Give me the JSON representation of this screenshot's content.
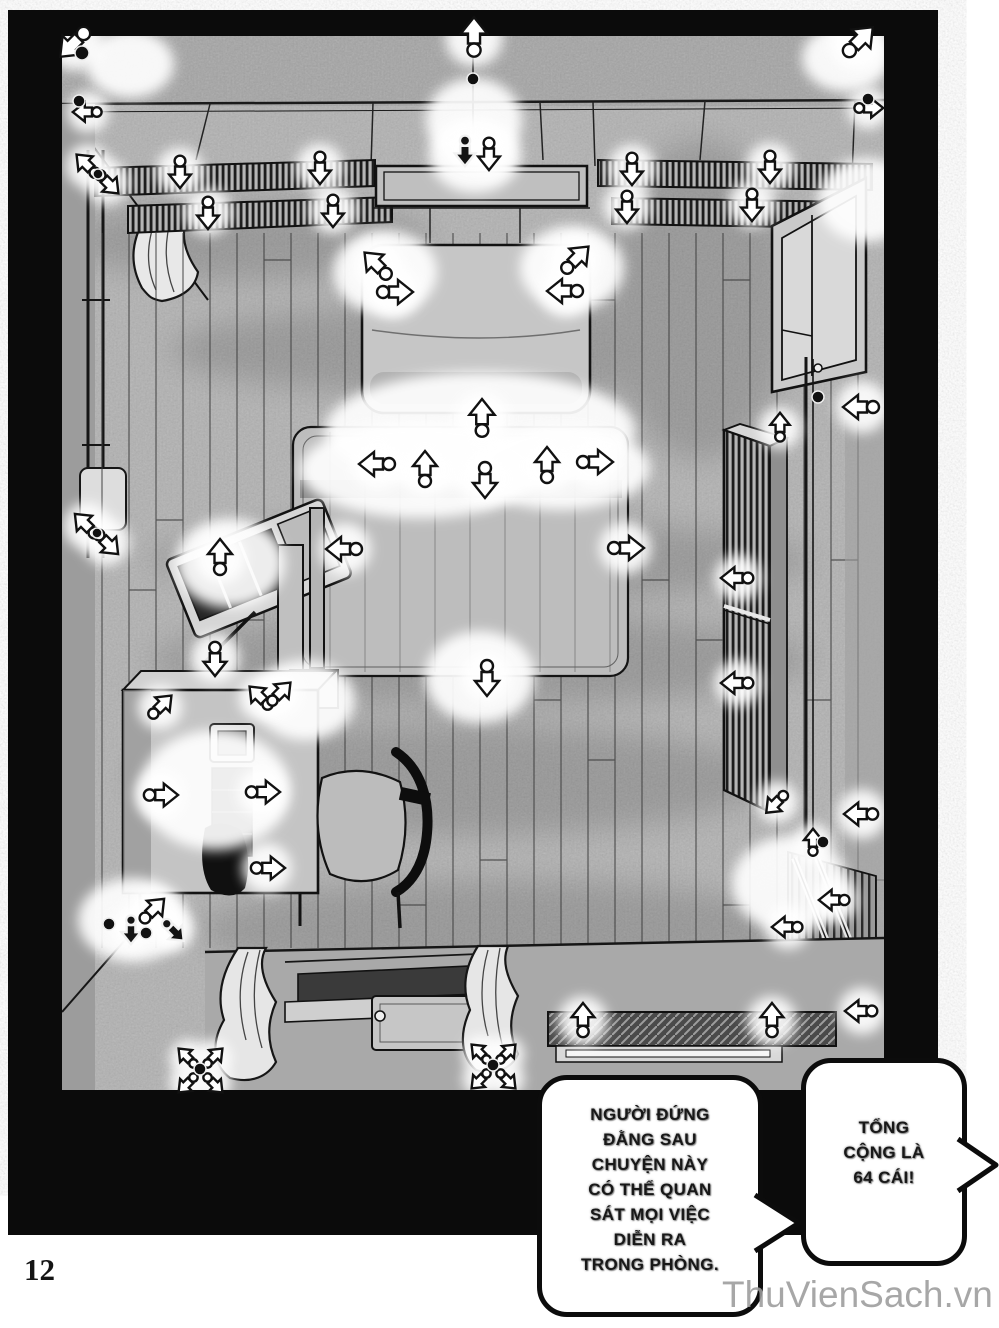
{
  "page": {
    "number": "12",
    "watermark": "ThuVienSach.vn"
  },
  "bubbles": {
    "left": {
      "lines": [
        "NGƯỜI ĐỨNG",
        "ĐẰNG SAU",
        "CHUYỆN NÀY",
        "CÓ THỂ QUAN",
        "SÁT MỌI VIỆC",
        "DIỄN RA",
        "TRONG PHÒNG."
      ]
    },
    "right": {
      "lines": [
        "TỔNG",
        "CỘNG LÀ",
        "64 CÁI!"
      ]
    }
  },
  "colors": {
    "panel_black": "#0b0b0b",
    "tone_gray": "#b1b1b1",
    "watermark_gray": "#9c9c9c"
  },
  "illustration": {
    "arrows": [
      {
        "x": 75,
        "y": 42,
        "r": 225,
        "v": "w",
        "s": 1.1
      },
      {
        "x": 474,
        "y": 38,
        "r": 0,
        "v": "w",
        "s": 1.1
      },
      {
        "x": 858,
        "y": 42,
        "r": 45,
        "v": "w",
        "s": 1.1
      },
      {
        "x": 88,
        "y": 112,
        "r": 270,
        "v": "w",
        "s": 0.8
      },
      {
        "x": 868,
        "y": 108,
        "r": 90,
        "v": "w",
        "s": 0.8
      },
      {
        "x": 180,
        "y": 171,
        "r": 180,
        "v": "w",
        "s": 0.9
      },
      {
        "x": 320,
        "y": 167,
        "r": 180,
        "v": "w",
        "s": 0.9
      },
      {
        "x": 208,
        "y": 212,
        "r": 180,
        "v": "w",
        "s": 0.9
      },
      {
        "x": 333,
        "y": 210,
        "r": 180,
        "v": "w",
        "s": 0.9
      },
      {
        "x": 632,
        "y": 168,
        "r": 180,
        "v": "w",
        "s": 0.9
      },
      {
        "x": 770,
        "y": 166,
        "r": 180,
        "v": "w",
        "s": 0.9
      },
      {
        "x": 627,
        "y": 206,
        "r": 180,
        "v": "w",
        "s": 0.9
      },
      {
        "x": 752,
        "y": 204,
        "r": 180,
        "v": "w",
        "s": 0.9
      },
      {
        "x": 465,
        "y": 150,
        "r": 180,
        "v": "b",
        "s": 0.85
      },
      {
        "x": 489,
        "y": 153,
        "r": 180,
        "v": "w",
        "s": 0.9
      },
      {
        "x": 378,
        "y": 266,
        "r": 315,
        "v": "w",
        "s": 1
      },
      {
        "x": 394,
        "y": 292,
        "r": 90,
        "v": "w",
        "s": 1
      },
      {
        "x": 575,
        "y": 260,
        "r": 45,
        "v": "w",
        "s": 1
      },
      {
        "x": 566,
        "y": 291,
        "r": 270,
        "v": "w",
        "s": 1
      },
      {
        "x": 482,
        "y": 419,
        "r": 0,
        "v": "w",
        "s": 1.05
      },
      {
        "x": 378,
        "y": 464,
        "r": 270,
        "v": "w",
        "s": 1
      },
      {
        "x": 425,
        "y": 470,
        "r": 0,
        "v": "w",
        "s": 1
      },
      {
        "x": 485,
        "y": 479,
        "r": 180,
        "v": "w",
        "s": 1
      },
      {
        "x": 547,
        "y": 466,
        "r": 0,
        "v": "w",
        "s": 1
      },
      {
        "x": 594,
        "y": 462,
        "r": 90,
        "v": "w",
        "s": 1
      },
      {
        "x": 345,
        "y": 549,
        "r": 270,
        "v": "w",
        "s": 1
      },
      {
        "x": 625,
        "y": 548,
        "r": 90,
        "v": "w",
        "s": 1
      },
      {
        "x": 487,
        "y": 677,
        "r": 180,
        "v": "w",
        "s": 1
      },
      {
        "x": 88,
        "y": 166,
        "r": 315,
        "v": "w",
        "s": 0.85
      },
      {
        "x": 107,
        "y": 182,
        "r": 135,
        "v": "w",
        "s": 0.85
      },
      {
        "x": 87,
        "y": 526,
        "r": 315,
        "v": "w",
        "s": 0.9
      },
      {
        "x": 106,
        "y": 542,
        "r": 135,
        "v": "w",
        "s": 0.9
      },
      {
        "x": 220,
        "y": 558,
        "r": 0,
        "v": "w",
        "s": 1
      },
      {
        "x": 215,
        "y": 658,
        "r": 180,
        "v": "w",
        "s": 0.95
      },
      {
        "x": 160,
        "y": 707,
        "r": 45,
        "v": "w",
        "s": 0.85
      },
      {
        "x": 261,
        "y": 698,
        "r": 315,
        "v": "w",
        "s": 0.85
      },
      {
        "x": 279,
        "y": 694,
        "r": 45,
        "v": "w",
        "s": 0.85
      },
      {
        "x": 160,
        "y": 795,
        "r": 90,
        "v": "w",
        "s": 0.95
      },
      {
        "x": 262,
        "y": 792,
        "r": 90,
        "v": "w",
        "s": 0.95
      },
      {
        "x": 267,
        "y": 868,
        "r": 90,
        "v": "w",
        "s": 0.95
      },
      {
        "x": 152,
        "y": 911,
        "r": 45,
        "v": "w",
        "s": 0.9
      },
      {
        "x": 173,
        "y": 930,
        "r": 135,
        "v": "b",
        "s": 0.8
      },
      {
        "x": 131,
        "y": 929,
        "r": 180,
        "v": "b",
        "s": 0.8
      },
      {
        "x": 862,
        "y": 407,
        "r": 270,
        "v": "w",
        "s": 1
      },
      {
        "x": 780,
        "y": 428,
        "r": 0,
        "v": "w",
        "s": 0.8
      },
      {
        "x": 738,
        "y": 578,
        "r": 270,
        "v": "w",
        "s": 0.9
      },
      {
        "x": 738,
        "y": 683,
        "r": 270,
        "v": "w",
        "s": 0.9
      },
      {
        "x": 777,
        "y": 802,
        "r": 225,
        "v": "w",
        "s": 0.8
      },
      {
        "x": 862,
        "y": 814,
        "r": 270,
        "v": "w",
        "s": 0.95
      },
      {
        "x": 813,
        "y": 843,
        "r": 0,
        "v": "w",
        "s": 0.75
      },
      {
        "x": 835,
        "y": 900,
        "r": 270,
        "v": "w",
        "s": 0.85
      },
      {
        "x": 788,
        "y": 927,
        "r": 270,
        "v": "w",
        "s": 0.85
      },
      {
        "x": 862,
        "y": 1011,
        "r": 270,
        "v": "w",
        "s": 0.9
      },
      {
        "x": 583,
        "y": 1021,
        "r": 0,
        "v": "w",
        "s": 0.95
      },
      {
        "x": 772,
        "y": 1021,
        "r": 0,
        "v": "w",
        "s": 0.95
      },
      {
        "x": 188,
        "y": 1058,
        "r": 315,
        "v": "w",
        "s": 0.7
      },
      {
        "x": 213,
        "y": 1058,
        "r": 45,
        "v": "w",
        "s": 0.7
      },
      {
        "x": 188,
        "y": 1083,
        "r": 225,
        "v": "w",
        "s": 0.7
      },
      {
        "x": 213,
        "y": 1083,
        "r": 135,
        "v": "w",
        "s": 0.7
      },
      {
        "x": 481,
        "y": 1054,
        "r": 315,
        "v": "w",
        "s": 0.7
      },
      {
        "x": 506,
        "y": 1054,
        "r": 45,
        "v": "w",
        "s": 0.7
      },
      {
        "x": 481,
        "y": 1079,
        "r": 225,
        "v": "w",
        "s": 0.7
      },
      {
        "x": 506,
        "y": 1079,
        "r": 135,
        "v": "w",
        "s": 0.7
      }
    ],
    "dots": [
      {
        "x": 82,
        "y": 53,
        "r": 7
      },
      {
        "x": 79,
        "y": 101,
        "r": 6
      },
      {
        "x": 868,
        "y": 99,
        "r": 6
      },
      {
        "x": 473,
        "y": 79,
        "r": 6
      },
      {
        "x": 98,
        "y": 174,
        "r": 5
      },
      {
        "x": 97,
        "y": 533,
        "r": 5
      },
      {
        "x": 818,
        "y": 397,
        "r": 6
      },
      {
        "x": 823,
        "y": 842,
        "r": 6
      },
      {
        "x": 200,
        "y": 1069,
        "r": 6
      },
      {
        "x": 493,
        "y": 1065,
        "r": 6
      },
      {
        "x": 146,
        "y": 933,
        "r": 6
      },
      {
        "x": 109,
        "y": 924,
        "r": 6
      }
    ],
    "glows": [
      {
        "x": 130,
        "y": 64,
        "rx": 44,
        "ry": 34
      },
      {
        "x": 474,
        "y": 120,
        "rx": 48,
        "ry": 42
      },
      {
        "x": 846,
        "y": 58,
        "rx": 44,
        "ry": 34
      },
      {
        "x": 866,
        "y": 200,
        "rx": 48,
        "ry": 42
      },
      {
        "x": 480,
        "y": 430,
        "rx": 155,
        "ry": 58
      },
      {
        "x": 420,
        "y": 470,
        "rx": 120,
        "ry": 48
      },
      {
        "x": 560,
        "y": 468,
        "rx": 90,
        "ry": 42
      },
      {
        "x": 480,
        "y": 677,
        "rx": 55,
        "ry": 46
      },
      {
        "x": 215,
        "y": 790,
        "rx": 75,
        "ry": 60
      },
      {
        "x": 230,
        "y": 563,
        "rx": 55,
        "ry": 45
      },
      {
        "x": 133,
        "y": 920,
        "rx": 55,
        "ry": 42
      },
      {
        "x": 790,
        "y": 884,
        "rx": 58,
        "ry": 48
      },
      {
        "x": 385,
        "y": 272,
        "rx": 52,
        "ry": 42
      },
      {
        "x": 572,
        "y": 268,
        "rx": 52,
        "ry": 42
      },
      {
        "x": 305,
        "y": 700,
        "rx": 50,
        "ry": 40
      },
      {
        "x": 475,
        "y": 155,
        "rx": 46,
        "ry": 38
      }
    ]
  }
}
